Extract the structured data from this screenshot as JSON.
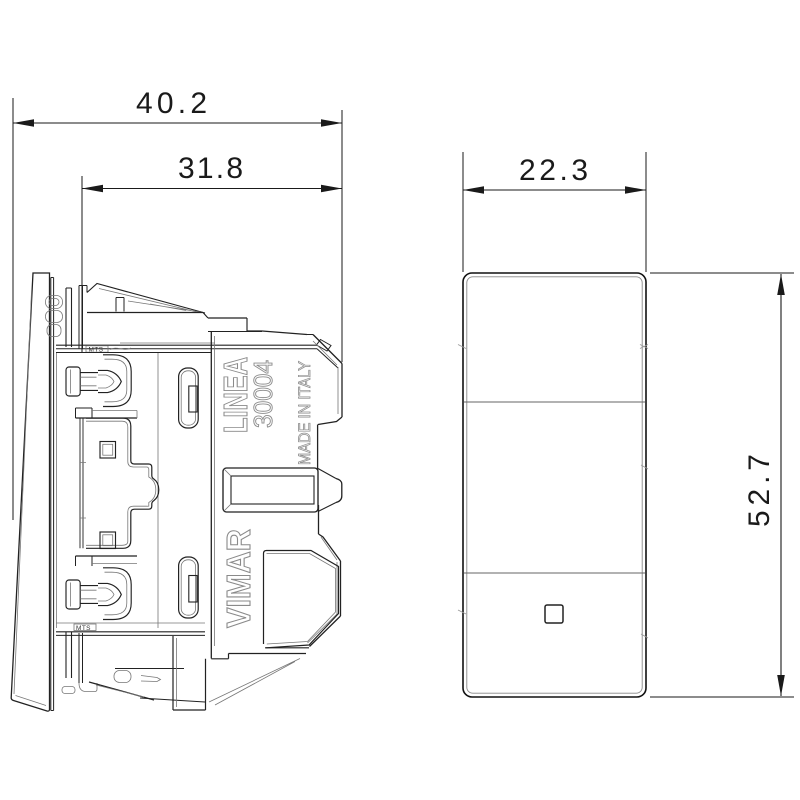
{
  "drawing": {
    "type": "product dimension drawing, side view and front view of a rocker switch module",
    "product": {
      "brand": "VIMAR",
      "series": "LINEA",
      "model": "30004",
      "origin": "MADE IN ITALY",
      "marking": "MTS"
    },
    "dimensions": {
      "overall_depth": "40.2",
      "mechanism_depth": "31.8",
      "front_width": "22.3",
      "front_height": "52.7"
    },
    "colors": {
      "background": "#ffffff",
      "line": "#1a1a1a",
      "thin_line": "#777777",
      "molded_text": "#8e8e8e"
    }
  }
}
